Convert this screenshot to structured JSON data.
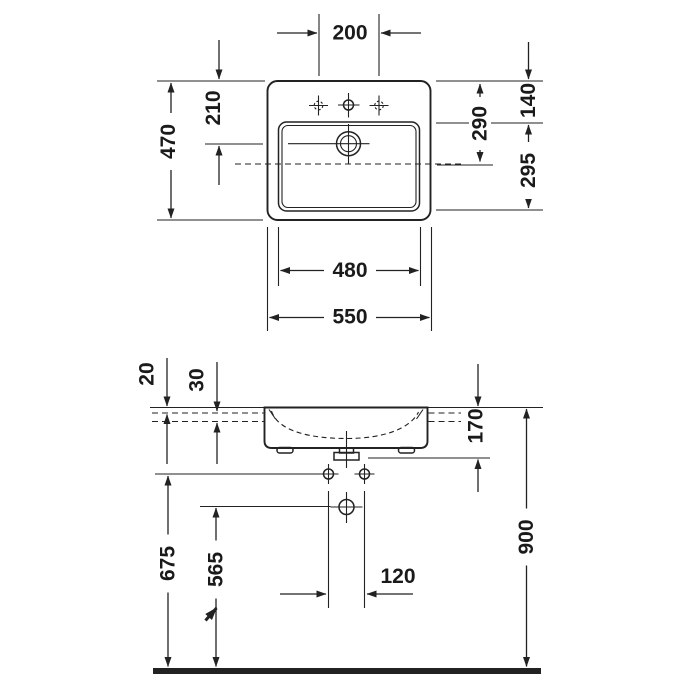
{
  "drawing": {
    "type": "washbasin technical dimension drawing",
    "background": "#ffffff",
    "line_color": "#222222",
    "text_color": "#1a1a1a",
    "views": {
      "top_view": {
        "label": "plan view",
        "dims": {
          "faucet_spacing": "200",
          "overall_depth": "470",
          "edge_to_drain": "210",
          "edge_to_basin_front": "140",
          "edge_to_overflow": "290",
          "basin_depth": "295",
          "basin_width": "480",
          "overall_width": "550"
        }
      },
      "front_view": {
        "label": "front elevation",
        "dims": {
          "rim_above_counter": "20",
          "counter_thickness": "30",
          "rim_to_outlet_flange": "170",
          "rim_height_above_floor": "900",
          "fixing_bolt_height": "675",
          "outlet_height": "565",
          "fixing_bolt_spacing": "120"
        }
      }
    }
  }
}
